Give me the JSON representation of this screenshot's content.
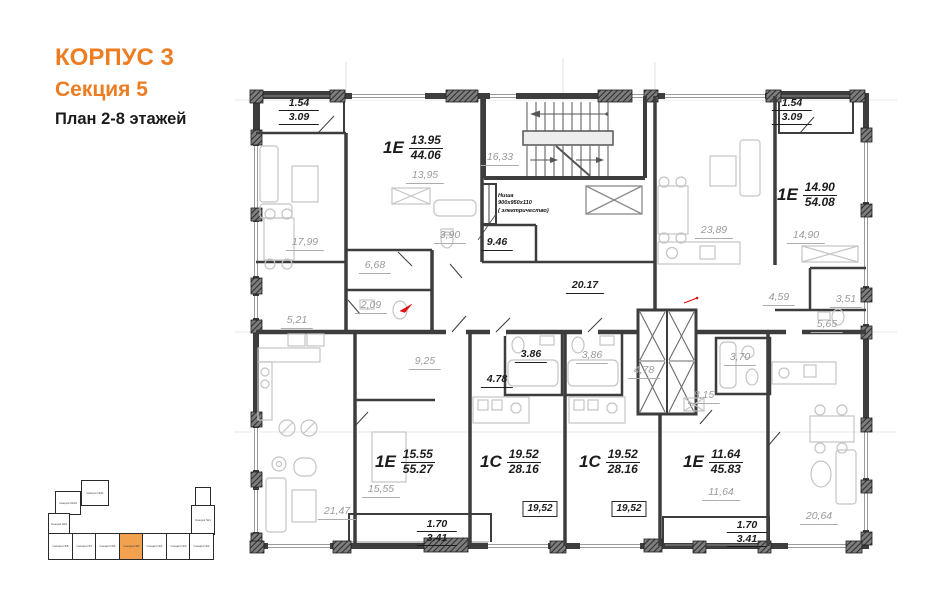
{
  "header": {
    "building": "КОРПУС 3",
    "section": "Секция 5",
    "plan_title": "План 2-8 этажей"
  },
  "colors": {
    "accent": "#ED7D22",
    "minimap_highlight": "#F2A14E",
    "wall": "#3d3d3d",
    "area_label": "#9a9a9a",
    "dark_label": "#1f1f1f",
    "red_mark": "#e01010"
  },
  "apartments": [
    {
      "type": "1Е",
      "living_area": "13.95",
      "total_area": "44.06"
    },
    {
      "type": "1Е",
      "living_area": "14.90",
      "total_area": "54.08"
    },
    {
      "type": "1Е",
      "living_area": "15.55",
      "total_area": "55.27"
    },
    {
      "type": "1С",
      "living_area": "19.52",
      "total_area": "28.16"
    },
    {
      "type": "1С",
      "living_area": "19.52",
      "total_area": "28.16"
    },
    {
      "type": "1Е",
      "living_area": "11.64",
      "total_area": "45.83"
    }
  ],
  "room_labels": {
    "tl_living": "17,99",
    "tl_bedroom": "13,95",
    "tl_bath": "3,90",
    "tl_hall": "6,68",
    "stairwell": "16,33",
    "lobby": "9.46",
    "corridor": "20.17",
    "bl_kitchen": "5,21",
    "bl_wc": "2,09",
    "bl_hall": "9,25",
    "bl_living": "21,47",
    "bl_bedroom": "15,55",
    "tr_living": "23,89",
    "tr_bedroom": "14,90",
    "tr_hall": "4,59",
    "tr_wc": "3,51",
    "tr_corridor": "5,65",
    "st1_bath": "3.86",
    "st1_hall": "4.78",
    "st1_room": "19,52",
    "st2_bath": "3,86",
    "st2_hall": "4,78",
    "st2_room": "19,52",
    "br_bath": "3,70",
    "br_hall": "8,15",
    "br_bedroom": "11,64",
    "br_living": "20,64"
  },
  "balconies": {
    "top_left": {
      "width": "1.54",
      "area": "3.09"
    },
    "top_right": {
      "width": "1.54",
      "area": "3.09"
    },
    "bottom_left": {
      "width": "1.70",
      "area": "3.41"
    },
    "bottom_right": {
      "width": "1.70",
      "area": "3.41"
    }
  },
  "niche_note": {
    "line1": "Ниша",
    "line2": "900х950х110",
    "line3": "( электричество)"
  },
  "minimap": {
    "bottom_row": [
      "Секция №8",
      "Секция №7",
      "Секция №6",
      "Секция №5",
      "Секция №4",
      "Секция №3",
      "Секция №2"
    ],
    "upper_left_top": "Секция №11",
    "upper_left_mid": "Секция №10",
    "upper_left_low": "Секция №9",
    "right_block": "Секция №1",
    "highlighted": "Секция №5"
  }
}
